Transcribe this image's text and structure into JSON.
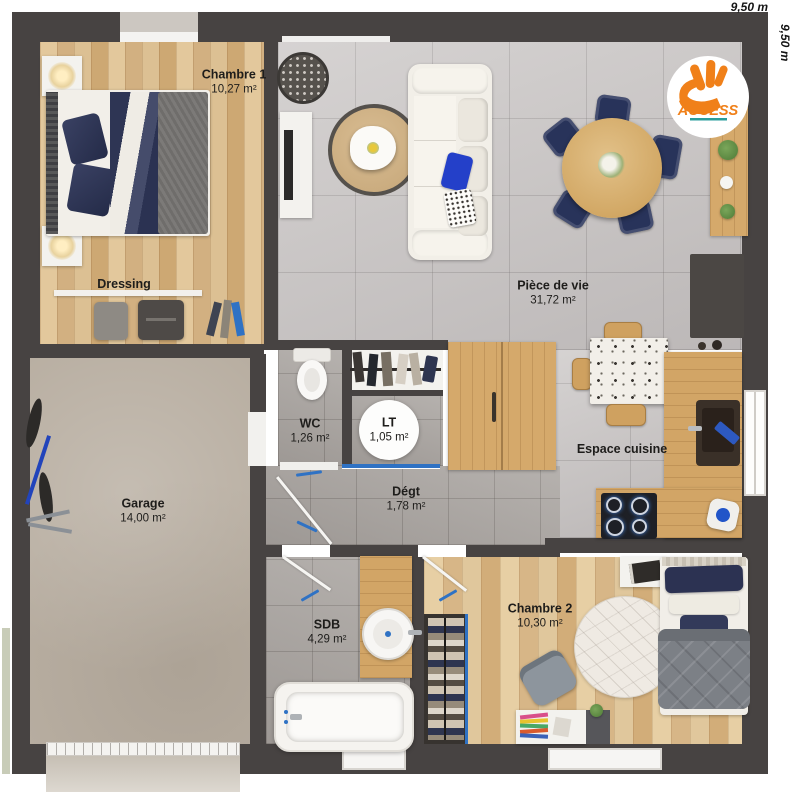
{
  "plan": {
    "title": "Plan de maison ACCESS",
    "dim_top": "9,50 m",
    "dim_right": "9,50 m",
    "logo": {
      "brand": "ACCESS"
    },
    "rooms": [
      {
        "name": "Chambre 1",
        "area": "10,27 m²"
      },
      {
        "name": "Dressing",
        "area": ""
      },
      {
        "name": "Pièce de vie",
        "area": "31,72 m²"
      },
      {
        "name": "WC",
        "area": "1,26 m²"
      },
      {
        "name": "LT",
        "area": "1,05 m²"
      },
      {
        "name": "Dégt",
        "area": "1,78 m²"
      },
      {
        "name": "Garage",
        "area": "14,00 m²"
      },
      {
        "name": "Espace cuisine",
        "area": ""
      },
      {
        "name": "SDB",
        "area": "4,29 m²"
      },
      {
        "name": "Chambre 2",
        "area": "10,30 m²"
      }
    ],
    "colors": {
      "wall": "#474342",
      "wood_floor": "#d8b88c",
      "tile_floor": "#c8c4c3",
      "garage_floor": "#b8aea1",
      "accent_navy": "#2b3252",
      "brand_orange": "#f08019",
      "brand_teal": "#2a9d9c",
      "door_blue": "#2f72c4"
    }
  }
}
